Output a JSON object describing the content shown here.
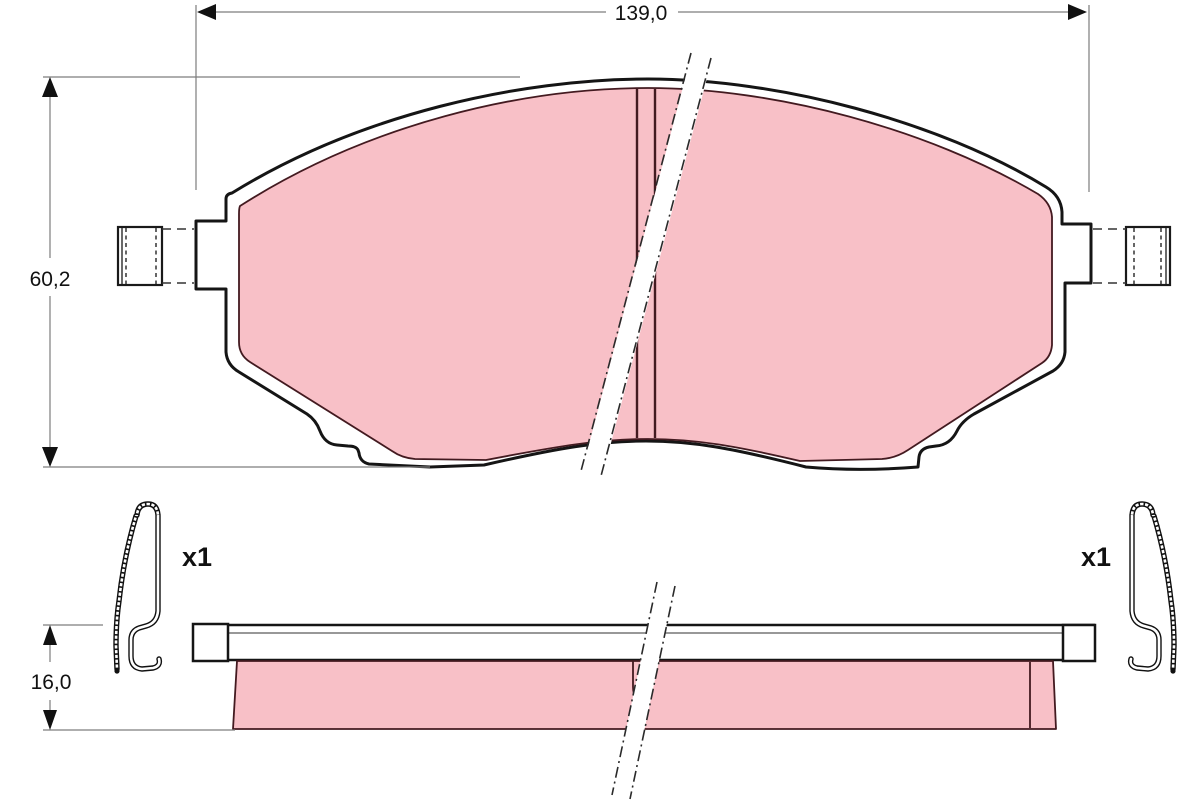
{
  "dimensions": {
    "width": "139,0",
    "height": "60,2",
    "thickness": "16,0"
  },
  "clips": {
    "left_qty": "x1",
    "right_qty": "x1"
  },
  "colors": {
    "friction": "#f8c0c7",
    "outline": "#151515",
    "friction_outline": "#431a20",
    "dimension_line": "#7d7d7d",
    "background": "#ffffff"
  }
}
